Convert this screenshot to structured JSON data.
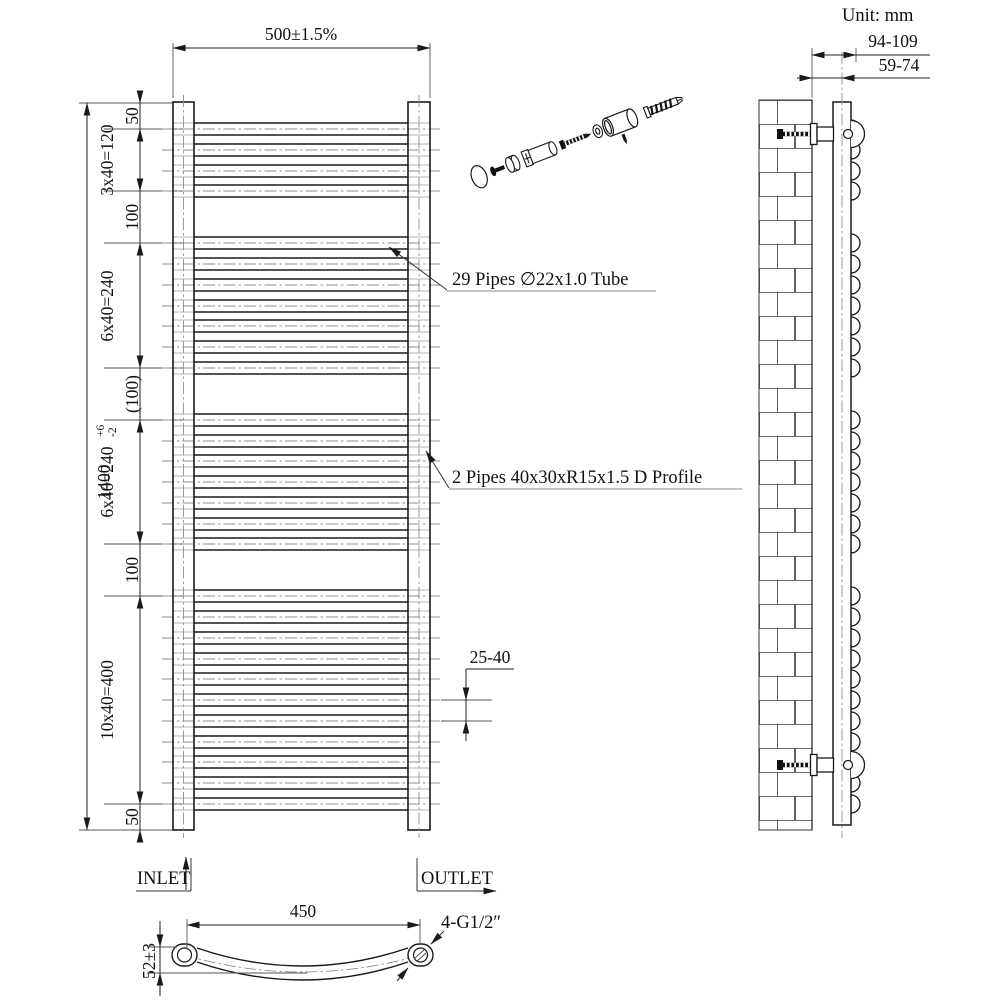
{
  "unit_label": "Unit: mm",
  "front_view": {
    "width_dim": "500±1.5%",
    "overall_height": "1400",
    "height_tol_plus": "+6",
    "height_tol_minus": "-2",
    "chain_dims": [
      "50",
      "3x40=120",
      "100",
      "6x40=240",
      "(100)",
      "6x40=240",
      "100",
      "10x40=400",
      "50"
    ],
    "gap_dim": "25-40",
    "pipes_label": "29 Pipes ∅22x1.0 Tube",
    "profile_label": "2 Pipes 40x30xR15x1.5 D Profile",
    "inlet_label": "INLET",
    "outlet_label": "OUTLET"
  },
  "side_view": {
    "wall_to_front_dim": "94-109",
    "wall_to_center_dim": "59-74"
  },
  "bottom_view": {
    "connection_centers_dim": "450",
    "depth_dim": "52±3",
    "thread_label": "4-G1/2″"
  },
  "colors": {
    "line": "#1a1a1a",
    "centerline": "#8f8f8f",
    "background": "#ffffff"
  }
}
